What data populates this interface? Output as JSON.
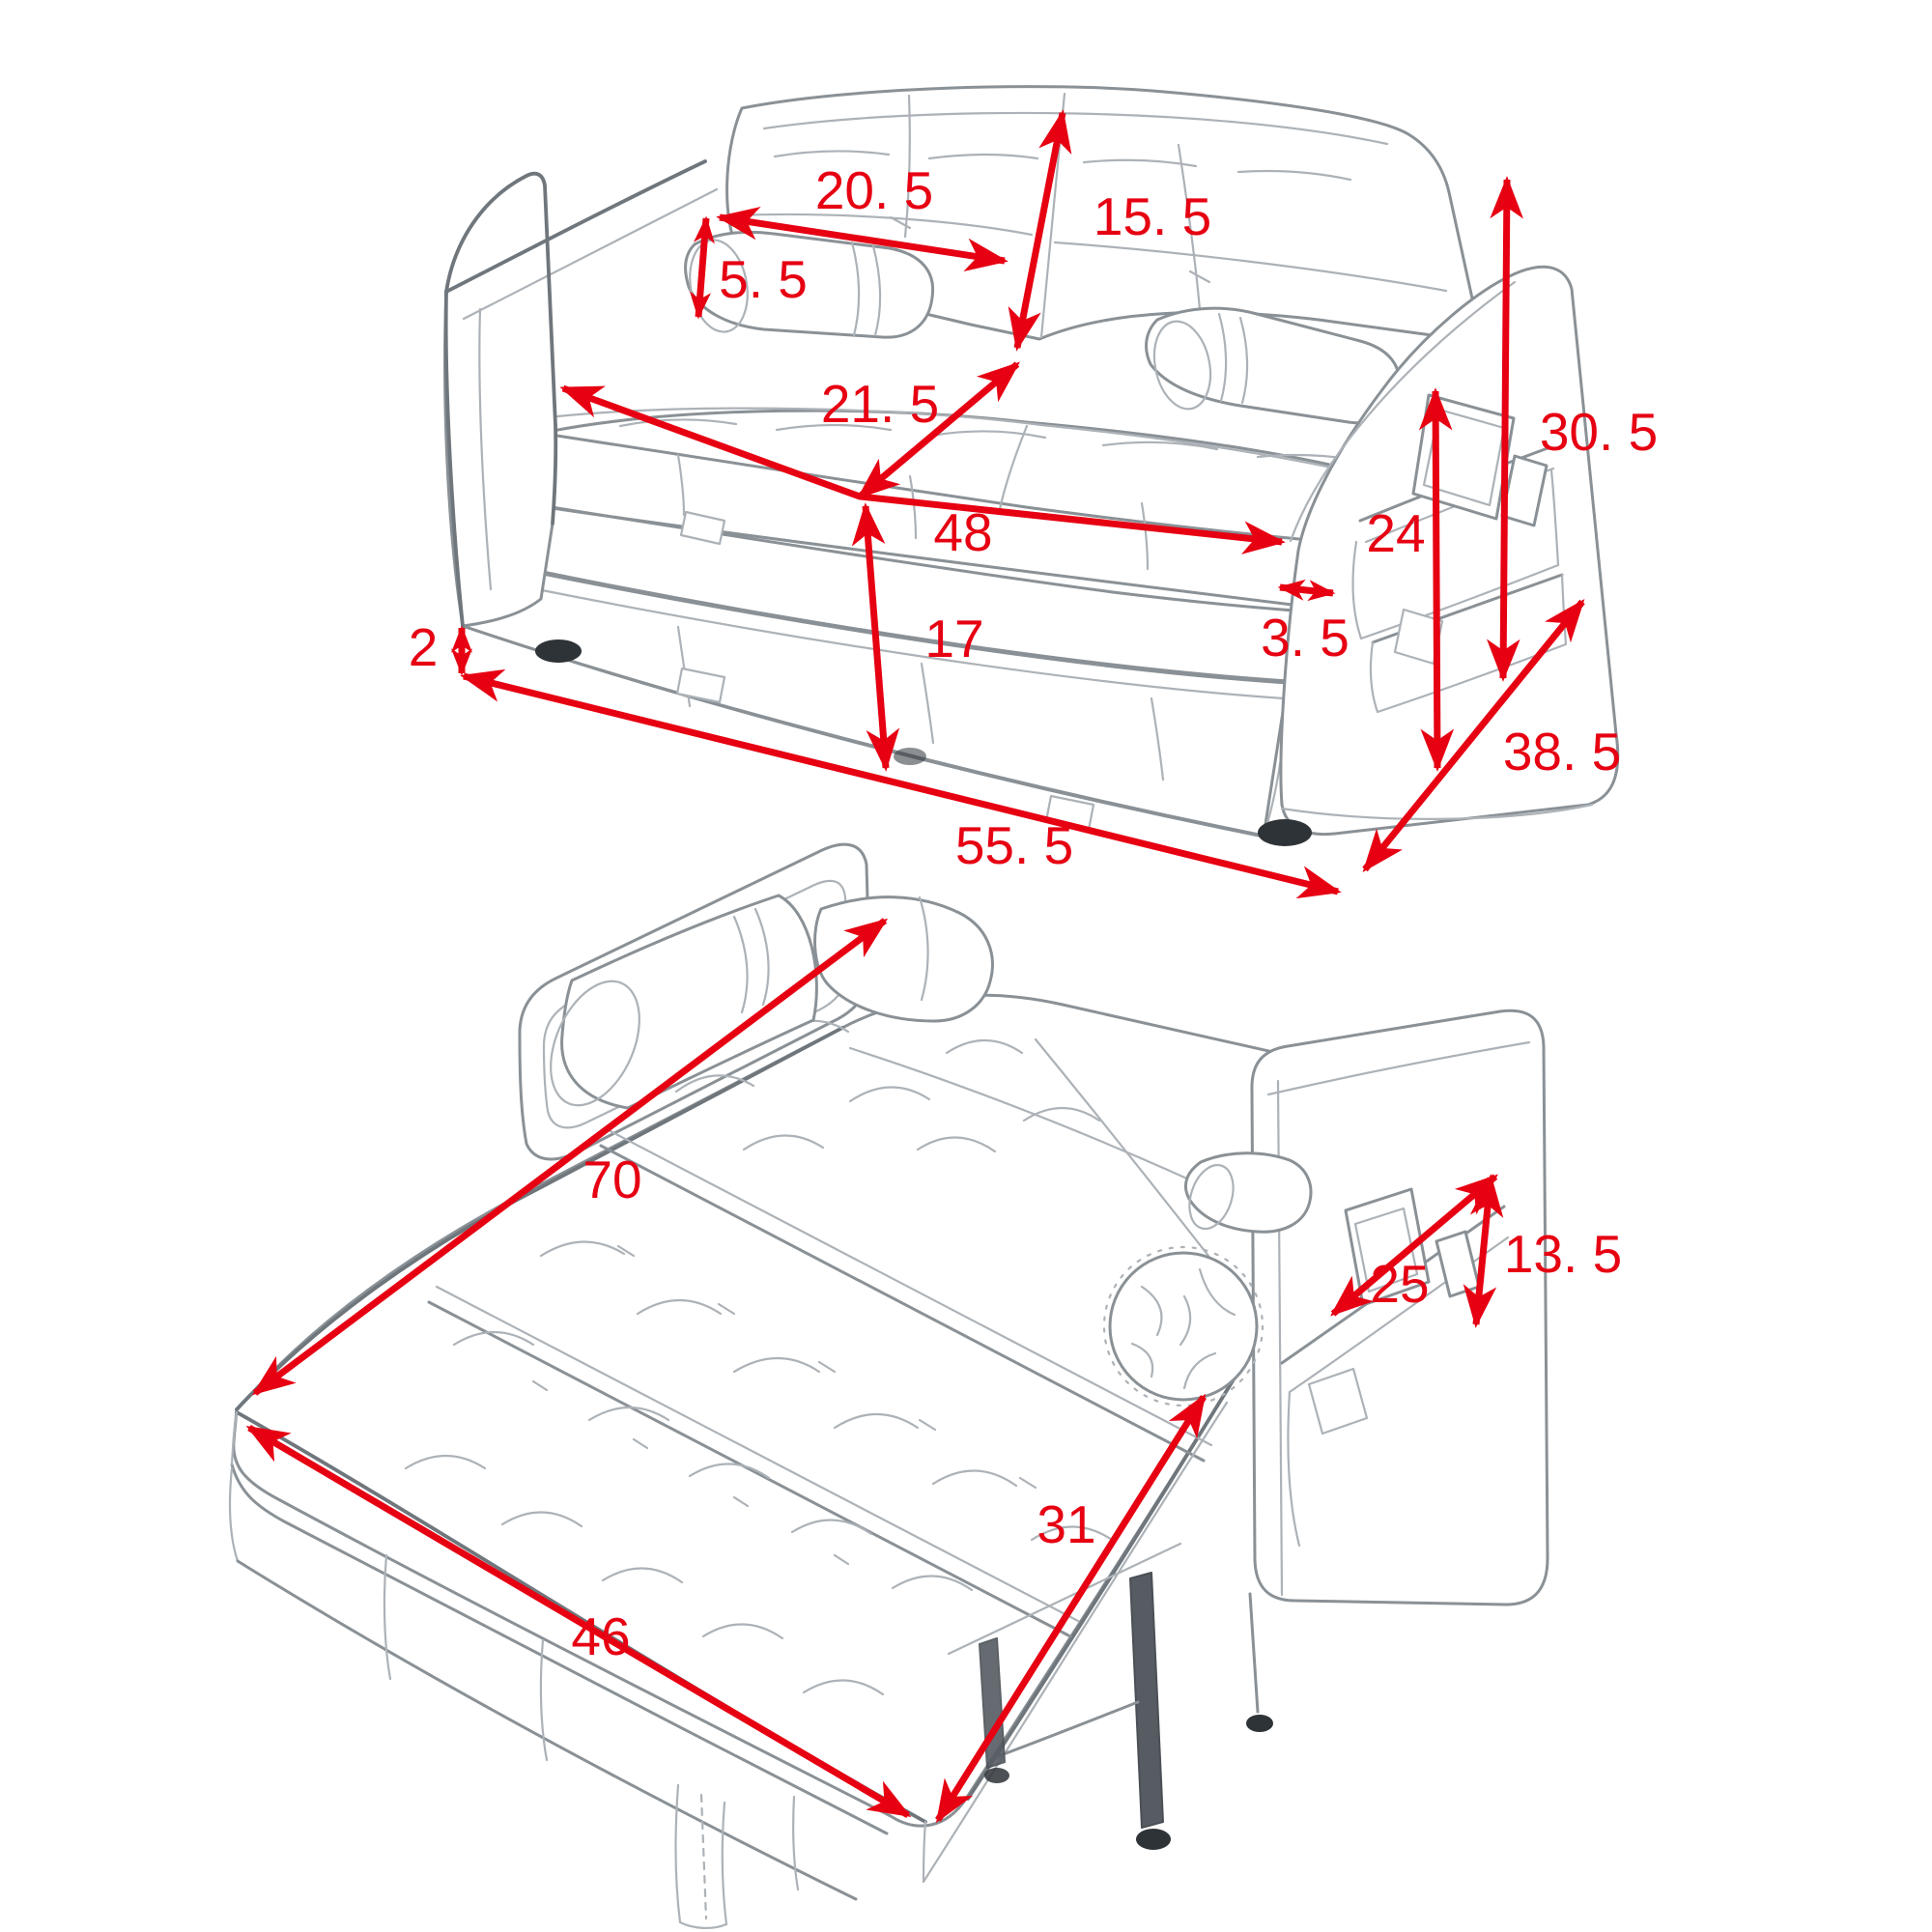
{
  "diagram": {
    "dimension_color": "#e60012",
    "sketch_color": "#8a9196",
    "background_color": "#ffffff"
  },
  "sofa_view": {
    "backrest_cushion_width": "20. 5",
    "backrest_height": "15. 5",
    "bolster_pillow_height": "5. 5",
    "seat_cushion_depth": "21. 5",
    "seat_width": "48",
    "pullout_base_height": "17",
    "seat_to_armrest_gap": "3. 5",
    "armrest_pocket_panel_height": "24",
    "armrest_overall_height": "30. 5",
    "overall_depth": "38. 5",
    "leg_height": "2",
    "overall_width": "55. 5"
  },
  "bed_view": {
    "bed_length": "70",
    "bed_width": "46",
    "pullout_deck_width": "31",
    "side_pocket_width": "25",
    "side_pocket_height": "13. 5"
  }
}
